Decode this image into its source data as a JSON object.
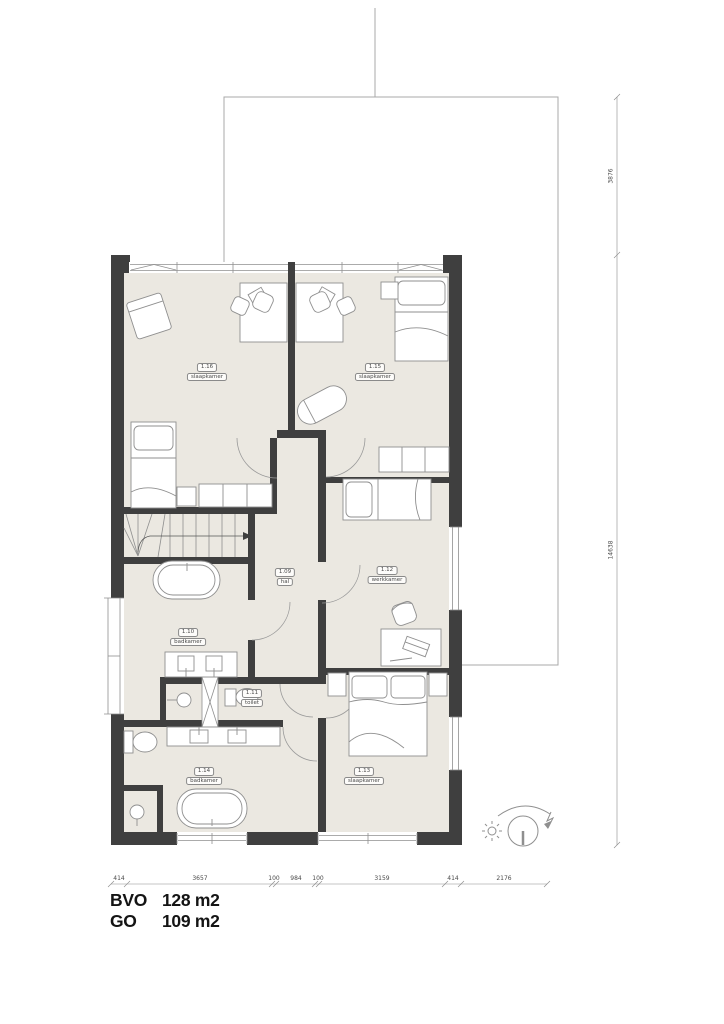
{
  "plan": {
    "rooms": [
      {
        "id": "1.16",
        "name": "slaapkamer"
      },
      {
        "id": "1.15",
        "name": "slaapkamer"
      },
      {
        "id": "1.09",
        "name": "hal"
      },
      {
        "id": "1.12",
        "name": "werkkamer"
      },
      {
        "id": "1.10",
        "name": "badkamer"
      },
      {
        "id": "1.11",
        "name": "toilet"
      },
      {
        "id": "1.14",
        "name": "badkamer"
      },
      {
        "id": "1.13",
        "name": "slaapkamer"
      }
    ],
    "dimensions_bottom": [
      "414",
      "3657",
      "100",
      "984",
      "100",
      "3159",
      "414",
      "2176"
    ],
    "dimensions_right": [
      "3876",
      "14638"
    ],
    "areas": {
      "bvo_label": "BVO",
      "bvo_value": "128 m2",
      "go_label": "GO",
      "go_value": "109 m2"
    },
    "colors": {
      "wall": "#3f3f3f",
      "floor": "#ebe8e1",
      "furniture_line": "#8f8f8f",
      "dim_text": "#4a4a4a"
    }
  }
}
